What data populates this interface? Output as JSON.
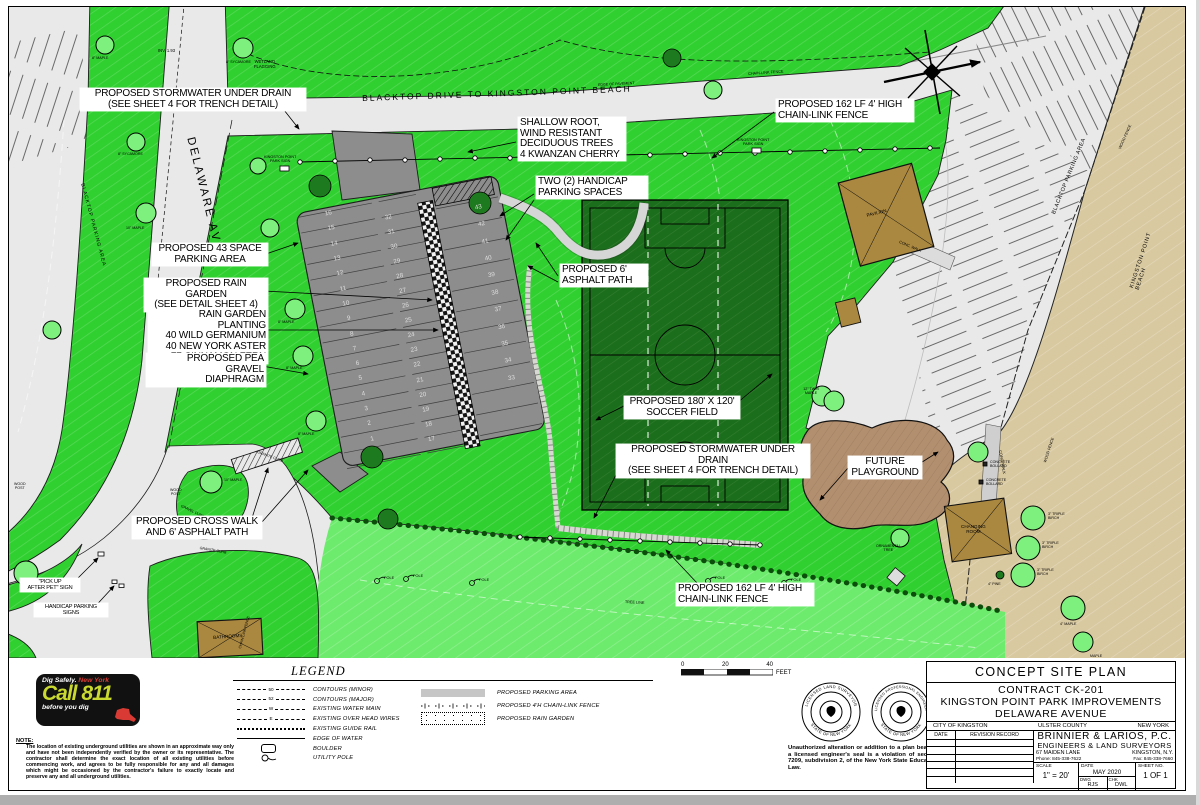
{
  "colors": {
    "bright_green": "#2fd02f",
    "light_green": "#6deb6d",
    "field_green": "#1b6e1b",
    "tree_green": "#7df07d",
    "dark_tree_green": "#1e7a1e",
    "pavement": "#e9e9e9",
    "lot_gray": "#8d8d8d",
    "beach_tan": "#d9c9a0",
    "building_brown": "#ab8840",
    "playground_brown": "#b28f6e",
    "call811_green": "#c9d92f",
    "call811_red": "#d93b34"
  },
  "map": {
    "callouts": [
      "PROPOSED STORMWATER UNDER DRAIN\n(SEE SHEET 4 FOR TRENCH DETAIL)",
      "SHALLOW ROOT,\nWIND RESISTANT\nDECIDUOUS TREES\n4 KWANZAN CHERRY",
      "TWO (2) HANDICAP\nPARKING SPACES",
      "PROPOSED 162 LF 4' HIGH\nCHAIN-LINK FENCE",
      "PROPOSED 43 SPACE\nPARKING AREA",
      "PROPOSED RAIN GARDEN\n(SEE DETAIL SHEET 4)",
      "RAIN GARDEN PLANTING\n40 WILD GERMANIUM\n40 NEW YORK ASTER\n77 CINNAMON FERN",
      "PROPOSED PEA GRAVEL\nDIAPHRAGM",
      "PROPOSED 6'\nASPHALT PATH",
      "PROPOSED 180' X 120'\nSOCCER FIELD",
      "PROPOSED STORMWATER UNDER DRAIN\n(SEE SHEET 4 FOR TRENCH DETAIL)",
      "FUTURE\nPLAYGROUND",
      "PROPOSED CROSS WALK\nAND 6' ASPHALT PATH",
      "PROPOSED 162 LF 4' HIGH\nCHAIN-LINK FENCE",
      "\"PICK UP\nAFTER PET\" SIGN",
      "HANDICAP PARKING\nSIGNS"
    ],
    "small_labels": [
      "BLACKTOP DRIVE TO KINGSTON POINT BEACH",
      "DELAWARE AVE.",
      "BLACKTOP PARKING AREA",
      "BLACKTOP PARKING AREA",
      "KINGSTON POINT BEACH",
      "PAVILION",
      "CHANGING\nROOM",
      "BATHROOMS",
      "WETLAND\nFLAGGING",
      "INV. 1.93",
      "KINGSTON POINT\nPARK SIGN",
      "KINGSTON POINT\nPARK SIGN",
      "CHAIN-LINK FENCE",
      "WOOD FENCE",
      "WOOD FENCE",
      "CONC. WALK",
      "CONC. WALK",
      "CONCRETE\nBOLLARD",
      "CONCRETE\nBOLLARD",
      "3\" TRIPLE\nBIRCH",
      "3\" TRIPLE\nBIRCH",
      "3\" TRIPLE\nBIRCH",
      "4\" PINE",
      "4\" MAPLE",
      "ORNAMENTAL\nTREE",
      "TREE LINE",
      "POLE",
      "POLE",
      "POLE",
      "POLE",
      "POLE",
      "12\" TWIN\nMAPLE",
      "GRANITE CURB",
      "GRANITE CURB",
      "GRAVEL CURB",
      "WOOD\nPOST",
      "WOOD\nPOST",
      "8\" MAPLE",
      "8\" SYCAMORE",
      "10\" MAPLE",
      "8\" MAPLE",
      "8\" MAPLE",
      "8\" MAPLE",
      "10\" MAPLE",
      "EDGE OF PAVEMENT",
      "CHAIN-LINK FENCE",
      "8\" SYCAMORE",
      "MAPLE"
    ],
    "parking": {
      "left": [
        "16",
        "15",
        "14",
        "13",
        "12",
        "11",
        "10",
        "9",
        "8",
        "7",
        "6",
        "5",
        "4",
        "3",
        "2",
        "1"
      ],
      "middle": [
        "32",
        "31",
        "30",
        "29",
        "28",
        "27",
        "26",
        "25",
        "24",
        "23",
        "22",
        "21",
        "20",
        "19",
        "18",
        "17"
      ],
      "right": [
        "43",
        "42",
        "41",
        "40",
        "39",
        "38",
        "37",
        "36",
        "35",
        "34",
        "33"
      ]
    }
  },
  "legend": {
    "title": "LEGEND",
    "left": [
      {
        "label": "CONTOURS (MINOR)",
        "tag": "50"
      },
      {
        "label": "CONTOURS (MAJOR)",
        "tag": "52"
      },
      {
        "label": "EXISTING WATER MAIN",
        "tag": "W"
      },
      {
        "label": "EXISTING OVER HEAD WIRES",
        "tag": "E"
      },
      {
        "label": "EXISTING GUIDE RAIL"
      },
      {
        "label": "EDGE OF WATER"
      },
      {
        "label": "BOULDER"
      },
      {
        "label": "UTILITY POLE"
      }
    ],
    "right": [
      {
        "label": "PROPOSED PARKING AREA"
      },
      {
        "label": "PROPOSED 4'H CHAIN-LINK FENCE"
      },
      {
        "label": "PROPOSED RAIN GARDEN"
      }
    ]
  },
  "scalebar": {
    "t0": "0",
    "t1": "20",
    "t2": "40",
    "unit": "FEET"
  },
  "seals": [
    {
      "top": "LICENSED LAND SURVEYOR",
      "bottom": "STATE OF NEW YORK"
    },
    {
      "top": "LICENSED PROFESSIONAL ENGINEER",
      "bottom": "STATE OF NEW YORK"
    }
  ],
  "alteration_note": "Unauthorized alteration or addition to a plan bearing a licensed engineer's seal is a violation of section 7209, subdivision 2, of the New York State Education Law.",
  "utility_note": {
    "heading": "NOTE:",
    "body": "The location of existing underground utilities are shown in an approximate way only and have not been independently verified by the owner or its representative. The contractor shall determine the exact location of all existing utilities before commencing work, and agrees to be fully responsible for any and all damages which might be occasioned by the contractor's failure to exactly locate and preserve any and all underground utilities."
  },
  "call811": {
    "line1a": "Dig Safely.",
    "line1b": "New York",
    "big": "Call 811",
    "line3": "before you dig"
  },
  "titleblock": {
    "plan_title": "CONCEPT SITE PLAN",
    "contract": "CONTRACT CK-201",
    "project": "KINGSTON POINT PARK IMPROVEMENTS",
    "street": "DELAWARE AVENUE",
    "city": "CITY OF KINGSTON",
    "county": "ULSTER COUNTY",
    "state": "NEW YORK",
    "rev_date": "DATE",
    "rev_record": "REVISION RECORD",
    "firm": "BRINNIER & LARIOS, P.C.",
    "firm2": "ENGINEERS & LAND SURVEYORS",
    "addr1": "67 MAIDEN LANE",
    "addr2": "KINGSTON, N.Y.",
    "phone": "Phone: 845-338-7622",
    "fax": "Fax: 845-338-7660",
    "scale_label": "SCALE",
    "scale": "1\" = 20'",
    "date_label": "DATE",
    "date": "MAY  2020",
    "dwg_label": "DWG",
    "dwg": "RJS",
    "chk_label": "CHK",
    "chk": "DWL",
    "sheet_label": "SHEET NO.",
    "sheet": "1 OF 1"
  }
}
